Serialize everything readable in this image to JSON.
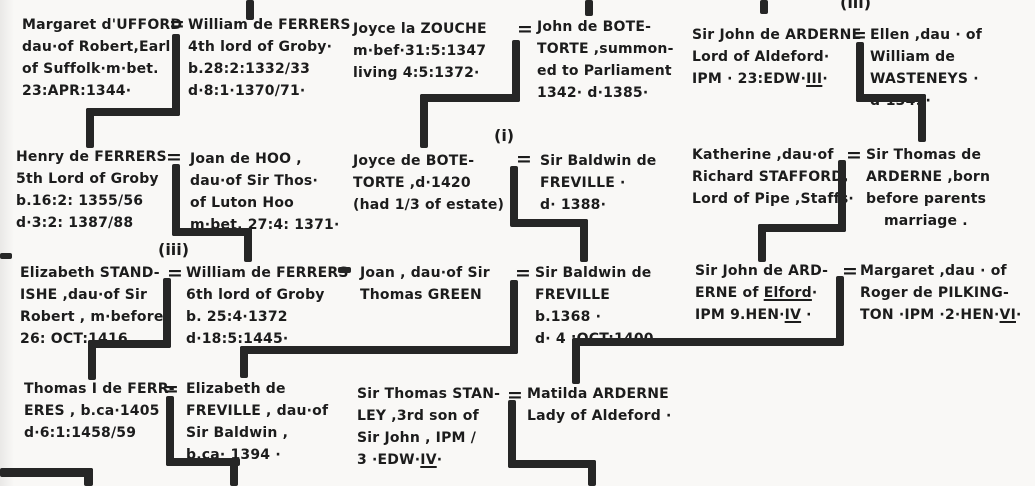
{
  "document": {
    "kind": "handwritten genealogy chart",
    "families": "Ferrers of Groby / Botetorte / Freville / Arderne / Stanley"
  },
  "equals": "=",
  "annotations": {
    "top_right_marriage": "(iii)",
    "freville_first_marriage": "(i)",
    "standishe_marriage": "(iii)"
  },
  "people": {
    "margaret_ufford": {
      "lines": [
        "Margaret d'UFFORD",
        "dau·of Robert,Earl",
        "of Suffolk·m·bet.",
        "23:APR:1344·"
      ]
    },
    "william_ferrers_4th": {
      "lines": [
        "William de FERRERS",
        "4th lord of Groby·",
        "b.28:2:1332/33",
        "d·8:1·1370/71·"
      ]
    },
    "joyce_la_zouche": {
      "lines": [
        "Joyce la ZOUCHE",
        "m·bef·31:5:1347",
        "living 4:5:1372·"
      ]
    },
    "john_de_botetorte": {
      "lines": [
        "John de BOTE-",
        "TORTE ,summon-",
        "ed to Parliament",
        "1342· d·1385·"
      ]
    },
    "john_arderne_aldeford": {
      "lines": [
        "Sir John de ARDERNE",
        "Lord of Aldeford·",
        "IPM · 23:EDW·__III__·"
      ]
    },
    "ellen_wasteneys": {
      "lines": [
        "Ellen ,dau · of",
        "William de",
        "WASTENEYS ·",
        "d·1349·"
      ]
    },
    "henry_ferrers_5th": {
      "lines": [
        "Henry de FERRERS",
        "5th Lord of Groby",
        "b.16:2: 1355/56",
        "d·3:2: 1387/88"
      ]
    },
    "joan_de_hoo": {
      "lines": [
        "Joan de HOO ,",
        "dau·of Sir Thos·",
        "of Luton Hoo",
        "m·bet. 27:4: 1371·"
      ]
    },
    "joyce_de_botetorte": {
      "lines": [
        "Joyce de BOTE-",
        "TORTE ,d·1420",
        "(had 1/3 of estate)"
      ]
    },
    "baldwin_freville_i": {
      "lines": [
        "Sir Baldwin de",
        "FREVILLE ·",
        "d· 1388·"
      ]
    },
    "katherine_stafford": {
      "lines": [
        "Katherine ,dau·of",
        "Richard STAFFORD,",
        "Lord of Pipe ,Staffs·"
      ]
    },
    "thomas_de_arderne": {
      "lines": [
        "Sir Thomas de",
        "ARDERNE ,born",
        "before parents",
        "marriage ."
      ]
    },
    "elizabeth_standishe": {
      "lines": [
        "Elizabeth STAND-",
        "ISHE ,dau·of Sir",
        "Robert , m·before",
        "26: OCT:1416"
      ]
    },
    "william_ferrers_6th": {
      "lines": [
        "William de FERRERS",
        "6th lord of Groby",
        "b. 25:4·1372",
        "d·18:5:1445·"
      ]
    },
    "joan_green": {
      "lines": [
        "Joan , dau·of Sir",
        "Thomas GREEN"
      ]
    },
    "baldwin_freville_ii": {
      "lines": [
        "Sir Baldwin de",
        "FREVILLE",
        "b.1368 ·",
        "d· 4 :OCT:1400"
      ]
    },
    "john_arderne_elford": {
      "lines": [
        "Sir John de ARD-",
        "ERNE of __Elford__·",
        "IPM 9.HEN·__IV__ ·"
      ]
    },
    "margaret_pilkington": {
      "lines": [
        "Margaret ,dau · of",
        "Roger de PILKING-",
        "TON ·IPM ·2·HEN·__VI__·"
      ]
    },
    "thomas_i_de_ferreres": {
      "lines": [
        "Thomas I de FERR-",
        "ERES , b.ca·1405",
        "d·6:1:1458/59"
      ]
    },
    "elizabeth_freville": {
      "lines": [
        "Elizabeth de",
        "FREVILLE , dau·of",
        "Sir Baldwin ,",
        "b.ca· 1394 ·"
      ]
    },
    "thomas_stanley": {
      "lines": [
        "Sir Thomas STAN-",
        "LEY ,3rd son of",
        "Sir John , IPM /",
        "3 ·EDW·__IV__·"
      ]
    },
    "matilda_arderne": {
      "lines": [
        "Matilda ARDERNE",
        "Lady of Aldeford ·"
      ]
    }
  }
}
